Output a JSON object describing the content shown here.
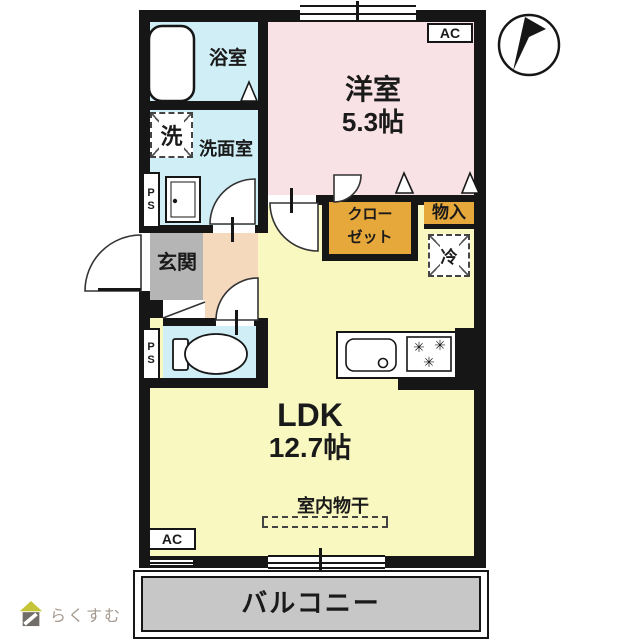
{
  "title": "floor-plan",
  "rooms": {
    "bath": {
      "label": "浴室"
    },
    "washer": {
      "label": "洗"
    },
    "washroom": {
      "label": "洗面室"
    },
    "western": {
      "label": "洋室",
      "size": "5.3帖"
    },
    "closet": {
      "line1": "クロー",
      "line2": "ゼット"
    },
    "storage": {
      "label": "物入"
    },
    "fridge": {
      "label": "冷"
    },
    "entrance": {
      "label": "玄関"
    },
    "ldk": {
      "label": "LDK",
      "size": "12.7帖"
    },
    "drying": {
      "label": "室内物干"
    },
    "balcony": {
      "label": "バルコニー"
    }
  },
  "badges": {
    "ac": "AC",
    "ps_line1": "P",
    "ps_line2": "S"
  },
  "icons": {
    "burner": "✳",
    "compass": "north-arrow",
    "logo_house": "house"
  },
  "logo": {
    "text": "らくすむ"
  },
  "colors": {
    "wall": "#161616",
    "wet_cyan": "#cfeef5",
    "western_pink": "#f8e2e6",
    "ldk_yellow": "#f9f8c0",
    "hallway_peach": "#f5d9bd",
    "entrance_gray": "#b5b5b5",
    "balcony_gray": "#c7c7c7",
    "closet_orange": "#e7a83b",
    "logo_text": "#a59a90",
    "logo_roof": "#c6c437",
    "logo_body": "#716d68"
  }
}
